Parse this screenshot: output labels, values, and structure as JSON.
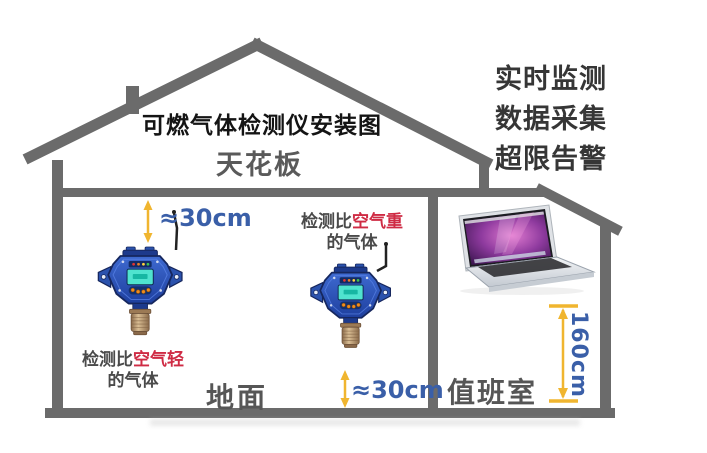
{
  "title": "可燃气体检测仪安装图",
  "labels": {
    "ceiling": "天花板",
    "floor": "地面",
    "duty_room": "值班室"
  },
  "features": [
    "实时监测",
    "数据采集",
    "超限告警"
  ],
  "measurements": {
    "ceiling_gap": "≈30cm",
    "floor_gap": "≈30cm",
    "laptop_height": "160cm"
  },
  "annotations": {
    "heavy_gas": {
      "prefix": "检测比",
      "highlight": "空气重",
      "suffix": "的气体"
    },
    "light_gas": {
      "prefix": "检测比",
      "highlight": "空气轻",
      "suffix": "的气体"
    }
  },
  "illustrations": {
    "house": "house-cross-section",
    "detector_upper": "gas-detector",
    "detector_lower": "gas-detector",
    "computer": "monitoring-laptop"
  },
  "palette": {
    "wall_gray": "#6b6b6b",
    "label_gray": "#5a5a5a",
    "title_black": "#141414",
    "feature_text": "#363636",
    "measure_blue": "#3a5fa8",
    "arrow_yellow": "#f0b52f",
    "highlight_red": "#cf2b44",
    "detector_blue": "#2b52ad",
    "detector_screen_teal": "#4fe3cf",
    "sensor_brass": "#b08f6e",
    "laptop_screen_purple": "#8e3a9e"
  }
}
